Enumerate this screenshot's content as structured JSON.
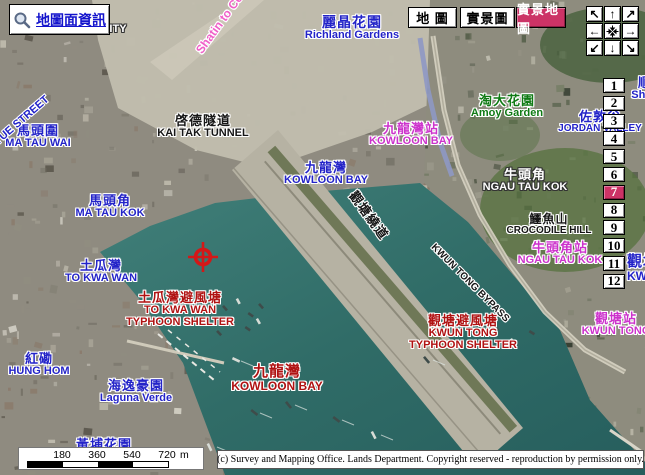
{
  "toolbar": {
    "map_info_label": "地圖面資訊",
    "view_buttons": [
      {
        "id": "map",
        "label": "地 圖",
        "selected": false,
        "x": 408,
        "w": 49
      },
      {
        "id": "aerial",
        "label": "實景圖",
        "selected": false,
        "x": 460,
        "w": 55
      },
      {
        "id": "aerial-map",
        "label": "實景地圖",
        "selected": true,
        "x": 516,
        "w": 50
      }
    ]
  },
  "nav_pad": {
    "buttons": [
      {
        "id": "pan-northwest",
        "glyph": "↖"
      },
      {
        "id": "pan-north",
        "glyph": "↑"
      },
      {
        "id": "pan-northeast",
        "glyph": "↗"
      },
      {
        "id": "pan-west",
        "glyph": "←"
      },
      {
        "id": "center-map",
        "glyph": "center-arrows-icon"
      },
      {
        "id": "pan-east",
        "glyph": "→"
      },
      {
        "id": "pan-southwest",
        "glyph": "↙"
      },
      {
        "id": "pan-south",
        "glyph": "↓"
      },
      {
        "id": "pan-southeast",
        "glyph": "↘"
      }
    ]
  },
  "zoom_levels": {
    "levels": [
      "1",
      "2",
      "3",
      "4",
      "5",
      "6",
      "7",
      "8",
      "9",
      "10",
      "11",
      "12"
    ],
    "active": "7"
  },
  "scale_bar": {
    "ticks": [
      "180",
      "360",
      "540",
      "720"
    ],
    "unit": "m"
  },
  "copyright": {
    "text": "(c) Survey and Mapping Office. Lands Department. Copyright reserved - reproduction by permission only."
  },
  "colors": {
    "blue": "#2323c8",
    "magenta": "#cc32cc",
    "red": "#b01212",
    "green": "#0f7a14",
    "black": "#161616",
    "white": "#ffffff",
    "pink": "#f060c8",
    "accent": "#cc3366"
  },
  "map_labels": [
    {
      "id": "kowloon-city",
      "en": "CITY",
      "color": "white",
      "cx": 114,
      "y": 24,
      "enSize": 11
    },
    {
      "id": "shatin-link",
      "en": "Shatin to Ce",
      "color": "pink",
      "x": 199,
      "y": 46,
      "rot": -54,
      "anchor": "left",
      "enSize": 12
    },
    {
      "id": "richland-gardens",
      "zh": "麗晶花園",
      "en": "Richland Gardens",
      "color": "blue",
      "cx": 352,
      "y": 15,
      "zhSize": 14,
      "enSize": 11
    },
    {
      "id": "kai-tak-tunnel",
      "zh": "啓德隧道",
      "en": "KAI TAK TUNNEL",
      "color": "black",
      "cx": 203,
      "y": 114,
      "zhSize": 13,
      "enSize": 11
    },
    {
      "id": "kowloon-bay-district",
      "zh": "九龍灣",
      "en": "KOWLOON BAY",
      "color": "blue",
      "cx": 326,
      "y": 161,
      "zhSize": 13,
      "enSize": 11
    },
    {
      "id": "kowloon-bay-station",
      "zh": "九龍灣站",
      "en": "KOWLOON BAY",
      "color": "magenta",
      "cx": 411,
      "y": 122,
      "zhSize": 13,
      "enSize": 11
    },
    {
      "id": "amoy-garden",
      "zh": "淘大花園",
      "en": "Amoy Garden",
      "color": "green",
      "cx": 507,
      "y": 94,
      "zhSize": 13,
      "enSize": 11
    },
    {
      "id": "jordan-valley",
      "zh": "佐敦谷",
      "en": "JORDAN VALLEY",
      "color": "blue",
      "cx": 600,
      "y": 110,
      "zhSize": 13,
      "enSize": 10
    },
    {
      "id": "shun-lee",
      "zh": "順",
      "en": "Shun",
      "color": "blue",
      "cx": 645,
      "y": 76,
      "zhSize": 13,
      "enSize": 11
    },
    {
      "id": "ma-tau-wai",
      "zh": "馬頭圍",
      "en": "MA TAU WAI",
      "color": "blue",
      "cx": 38,
      "y": 124,
      "zhSize": 13,
      "enSize": 11
    },
    {
      "id": "ma-tau-kok",
      "zh": "馬頭角",
      "en": "MA TAU KOK",
      "color": "blue",
      "cx": 110,
      "y": 194,
      "zhSize": 13,
      "enSize": 11
    },
    {
      "id": "to-kwa-wan",
      "zh": "土瓜灣",
      "en": "TO KWA WAN",
      "color": "blue",
      "cx": 101,
      "y": 259,
      "zhSize": 13,
      "enSize": 11
    },
    {
      "id": "tkw-typhoon-shelter",
      "zh": "土瓜灣避風塘",
      "en": "TO KWA WAN",
      "en2": "TYPHOON SHELTER",
      "color": "red",
      "cx": 180,
      "y": 291,
      "zhSize": 13,
      "enSize": 11
    },
    {
      "id": "hung-hom",
      "zh": "紅磡",
      "en": "HUNG HOM",
      "color": "blue",
      "cx": 39,
      "y": 352,
      "zhSize": 13,
      "enSize": 11
    },
    {
      "id": "laguna-verde",
      "zh": "海逸豪園",
      "en": "Laguna Verde",
      "color": "blue",
      "cx": 136,
      "y": 379,
      "zhSize": 13,
      "enSize": 11
    },
    {
      "id": "kowloon-bay-sea",
      "zh": "九龍灣",
      "en": "KOWLOON BAY",
      "color": "red",
      "cx": 277,
      "y": 364,
      "zhSize": 15,
      "enSize": 12
    },
    {
      "id": "ngau-tau-kok",
      "zh": "牛頭角",
      "en": "NGAU TAU KOK",
      "color": "white",
      "cx": 525,
      "y": 168,
      "zhSize": 13,
      "enSize": 11
    },
    {
      "id": "crocodile-hill",
      "zh": "鱷魚山",
      "en": "CROCODILE HILL",
      "color": "black",
      "cx": 549,
      "y": 213,
      "zhSize": 12,
      "enSize": 10
    },
    {
      "id": "ntk-station",
      "zh": "牛頭角站",
      "en": "NGAU TAU KOK",
      "color": "magenta",
      "cx": 560,
      "y": 241,
      "zhSize": 13,
      "enSize": 11
    },
    {
      "id": "kt-typhoon-shelter",
      "zh": "觀塘避風塘",
      "en": "KWUN TONG",
      "en2": "TYPHOON SHELTER",
      "color": "red",
      "cx": 463,
      "y": 314,
      "zhSize": 13,
      "enSize": 11
    },
    {
      "id": "kt-station",
      "zh": "觀塘站",
      "en": "KWUN TONG",
      "color": "magenta",
      "cx": 616,
      "y": 312,
      "zhSize": 13,
      "enSize": 11
    },
    {
      "id": "kwun-tong-district",
      "zh": "觀塘",
      "en": "KWUN TONG",
      "color": "blue",
      "x": 627,
      "y": 254,
      "anchor": "left",
      "zhSize": 15,
      "enSize": 12
    },
    {
      "id": "kwun-tong-bypass-en",
      "en": "KWUN TONG BYPASS",
      "color": "black",
      "x": 432,
      "y": 241,
      "rot": 45,
      "anchor": "left",
      "enSize": 10,
      "spacing": 1
    },
    {
      "id": "kwun-tong-bypass-zh",
      "zh": "觀塘繞道",
      "color": "black",
      "x": 352,
      "y": 186,
      "rot": 54,
      "anchor": "left",
      "zhSize": 13
    },
    {
      "id": "street-name",
      "en": "YUE STREET",
      "color": "blue",
      "x": -4,
      "y": 138,
      "rot": -41,
      "anchor": "left",
      "enSize": 11
    },
    {
      "id": "whampoa-garden",
      "zh": "黃埔花園",
      "color": "blue",
      "cx": 104,
      "y": 438,
      "zhSize": 13
    }
  ]
}
